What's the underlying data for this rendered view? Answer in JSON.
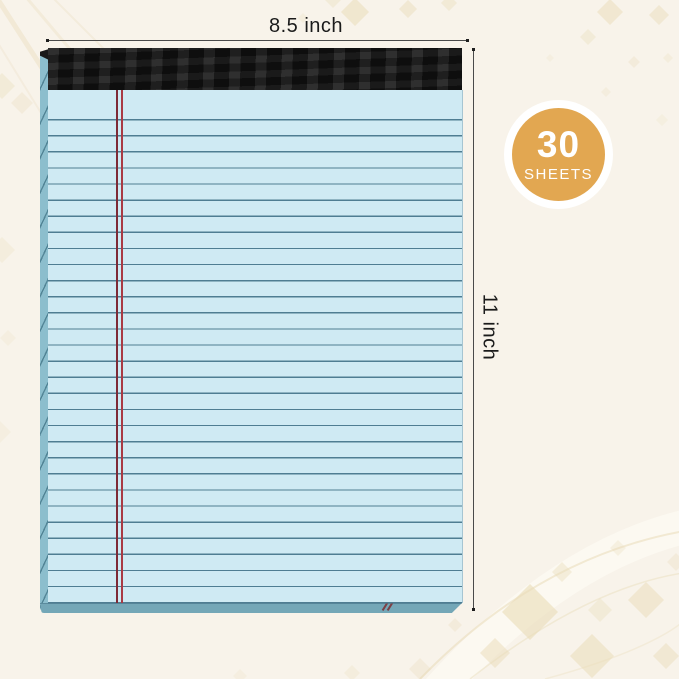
{
  "scene": {
    "description": "Blue legal pad product image with dimension annotations",
    "background_color": "#f8f3ea"
  },
  "notepad": {
    "binding_color": "#181818",
    "paper_color": "#cfeaf3",
    "rule_line_color": "#4f7d92",
    "margin_line_colors": [
      "#7d2a36",
      "#a93a44"
    ],
    "sheet_edge_color": "#8cbecd",
    "ruled_line_count": 30
  },
  "dimensions": {
    "width_label": "8.5 inch",
    "height_label": "11 inch",
    "line_color": "#4a4a4a"
  },
  "badge": {
    "count": "30",
    "unit": "SHEETS",
    "circle_color": "#e2a751",
    "ring_color": "#ffffff",
    "text_color": "#ffffff"
  }
}
